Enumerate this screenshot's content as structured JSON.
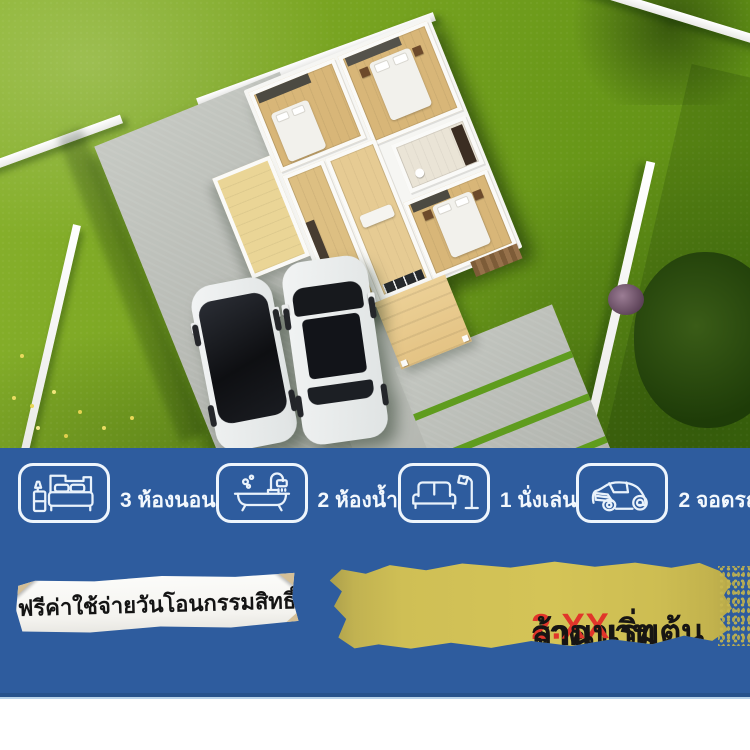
{
  "ad": {
    "features": [
      {
        "icon": "bed-icon",
        "label": "3 ห้องนอน"
      },
      {
        "icon": "bathtub-icon",
        "label": "2 ห้องน้ำ"
      },
      {
        "icon": "sofa-icon",
        "label": "1 นั่งเล่น"
      },
      {
        "icon": "car-icon",
        "label": "2 จอดรถ"
      }
    ],
    "note": {
      "text": "ฟรีค่าใช้จ่ายวันโอนกรรมสิทธิ์"
    },
    "price": {
      "prefix": "ราคาเริ่มต้น",
      "value": "2.XX",
      "suffix": "ล้านบาท"
    }
  },
  "scene": {
    "type": "3d-aerial-house-render",
    "elements": [
      "lawn",
      "white-fence",
      "concrete-driveway",
      "single-storey-house-floorplan",
      "black-suv",
      "white-suv",
      "entrance-deck",
      "paver-walkway",
      "shrubs"
    ]
  },
  "colors": {
    "band_blue": "#2e5c9e",
    "brush_yellow": "#d4c457",
    "price_red": "#e1352a",
    "note_paper": "#f7f6f3",
    "tape_beige": "#d3bd93",
    "grass_green": "#6f9d1c",
    "label_white": "#f3f8fd"
  }
}
